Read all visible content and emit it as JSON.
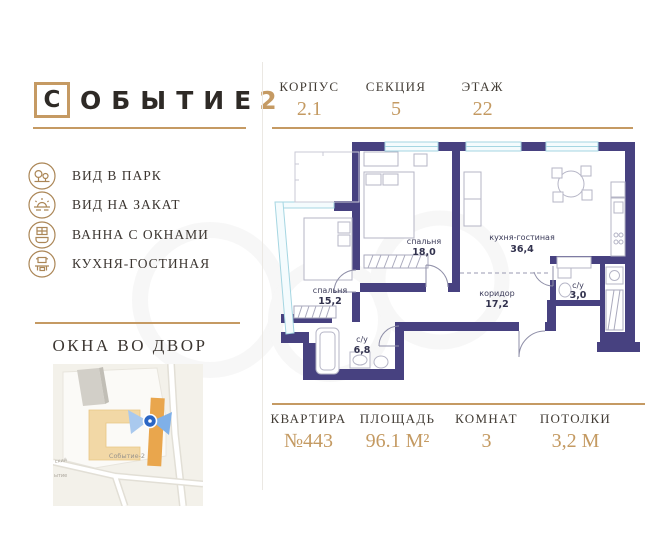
{
  "logo": {
    "boxed_letter": "С",
    "rest": "ОБЫТИЕ",
    "number": "2"
  },
  "header": {
    "items": [
      {
        "label": "КОРПУС",
        "value": "2.1"
      },
      {
        "label": "СЕКЦИЯ",
        "value": "5"
      },
      {
        "label": "ЭТАЖ",
        "value": "22"
      }
    ]
  },
  "features": [
    {
      "icon": "park-view-icon",
      "label": "ВИД В ПАРК"
    },
    {
      "icon": "sunset-view-icon",
      "label": "ВИД НА ЗАКАТ"
    },
    {
      "icon": "bath-windows-icon",
      "label": "ВАННА С ОКНАМИ"
    },
    {
      "icon": "kitchen-living-icon",
      "label": "КУХНЯ-ГОСТИНАЯ"
    }
  ],
  "courtyard": {
    "title": "ОКНА ВО ДВОР",
    "map_building_label": "Событие-2",
    "map_street_label_top": "ский",
    "map_street_label_bottom": "ытие"
  },
  "floorplan": {
    "rooms": [
      {
        "name": "спальня",
        "area": "18,0"
      },
      {
        "name": "кухня-гостиная",
        "area": "36,4"
      },
      {
        "name": "спальня",
        "area": "15,2"
      },
      {
        "name": "коридор",
        "area": "17,2"
      },
      {
        "name": "с/у",
        "area": "6,8"
      },
      {
        "name": "с/у",
        "area": "3,0"
      }
    ]
  },
  "summary": {
    "items": [
      {
        "label": "КВАРТИРА",
        "value": "№443"
      },
      {
        "label": "ПЛОЩАДЬ",
        "value": "96.1 М²"
      },
      {
        "label": "КОМНАТ",
        "value": "3"
      },
      {
        "label": "ПОТОЛКИ",
        "value": "3,2 М"
      }
    ]
  },
  "colors": {
    "accent_gold": "#c59a63",
    "wall_purple": "#474180",
    "window_cyan": "#a5d6e2",
    "map_orange": "#e9a64d",
    "map_beige": "#f2d8a6",
    "marker_blue": "#2f6fd1"
  }
}
